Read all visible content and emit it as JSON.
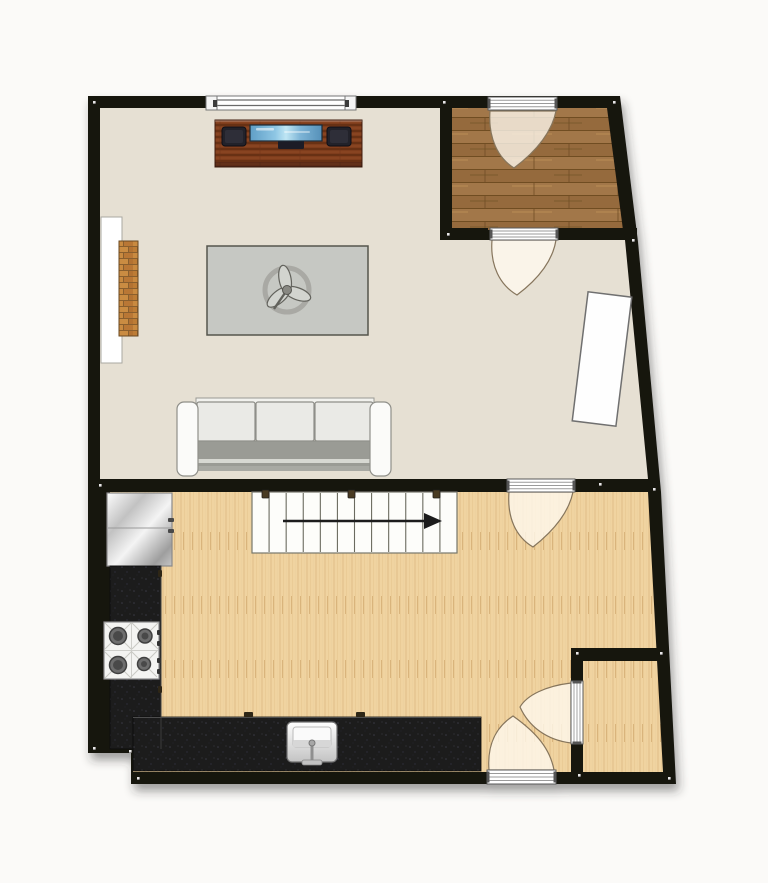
{
  "palette": {
    "background": "#fbfaf8",
    "wall": "#16120f",
    "living_floor": "#e6e0d3",
    "kitchen_floor": "#f0d3a0",
    "entry_floor": "#9d7243",
    "counter": "#1b1b1e",
    "door_swing_fill": "rgba(255,250,240,0.78)",
    "door_swing_stroke": "#86755c",
    "rug": "#c6c8c3",
    "stair_fill": "#fdfdfa",
    "tv_screen": "#8ec6e4",
    "console_wood": "#7f3e1e",
    "brick": "#c08038",
    "arrow": "#1a1a1a",
    "corner_dot": "#ffffff"
  },
  "plan": {
    "outline": "88,96 620,96 638,242 661,492 676,784 131,784 131,753 88,753",
    "floors": [
      {
        "name": "living-room-floor",
        "kind": "living",
        "points": "100,108 440,108 440,240 625,240 648,479 100,479"
      },
      {
        "name": "entry-vestibule-floor",
        "kind": "entry",
        "points": "452,108 607,108 623,230 452,230"
      },
      {
        "name": "kitchen-floor",
        "kind": "kitchen",
        "points": "110,492 648,492 663,772 133,772 133,741 110,741"
      }
    ],
    "interior_walls": [
      {
        "name": "wall-living-kitchen-left",
        "rect": [
          94,
          479,
          413,
          13
        ]
      },
      {
        "name": "wall-living-kitchen-right",
        "rect": [
          575,
          479,
          80,
          13
        ]
      },
      {
        "name": "wall-vestibule-left",
        "rect": [
          440,
          96,
          12,
          144
        ]
      },
      {
        "name": "wall-vestibule-bottom-left",
        "rect": [
          440,
          228,
          48,
          12
        ]
      },
      {
        "name": "wall-vestibule-bottom-right",
        "rect": [
          558,
          228,
          79,
          12
        ]
      },
      {
        "name": "wall-closet-top",
        "rect": [
          571,
          648,
          97,
          13
        ]
      },
      {
        "name": "wall-closet-left-upper",
        "rect": [
          571,
          661,
          12,
          21
        ]
      },
      {
        "name": "wall-closet-left-lower",
        "rect": [
          571,
          744,
          12,
          28
        ]
      }
    ],
    "window": {
      "name": "window-top-wall",
      "rect": [
        206,
        96,
        150,
        14
      ]
    },
    "doors": [
      {
        "name": "door-entry-exterior",
        "bar": [
          488,
          97,
          69,
          13
        ],
        "vertical": false,
        "swing": "M490,111 C488,138 498,158 514,168 C538,150 552,131 556,111 Z"
      },
      {
        "name": "door-entry-living",
        "bar": [
          490,
          228,
          68,
          12
        ],
        "vertical": false,
        "swing": "M492,240 C490,266 500,285 517,295 C541,277 553,259 556,240 Z"
      },
      {
        "name": "door-living-kitchen",
        "bar": [
          507,
          479,
          68,
          13
        ],
        "vertical": false,
        "swing": "M509,492 C507,518 516,537 533,547 C556,529 569,511 573,492 Z"
      },
      {
        "name": "door-closet",
        "bar": [
          571,
          681,
          12,
          63
        ],
        "vertical": true,
        "swing": "M571,683 C546,686 527,695 520,707 C529,727 547,740 571,743 Z"
      },
      {
        "name": "door-kitchen-exterior",
        "bar": [
          487,
          770,
          69,
          14
        ],
        "vertical": false,
        "swing": "M489,770 C487,745 496,727 513,716 C537,733 550,749 554,770 Z"
      }
    ],
    "stairs": {
      "name": "staircase",
      "rect": [
        252,
        492,
        205,
        61
      ],
      "treads": 11,
      "arrow": {
        "x1": 283,
        "y1": 521,
        "x2": 424,
        "y2": 521,
        "head": 18
      },
      "hooks": [
        [
          262,
          490
        ],
        [
          348,
          490
        ],
        [
          433,
          490
        ]
      ]
    },
    "furniture": {
      "tv_console": {
        "body": [
          215,
          120,
          147,
          47
        ],
        "screen": [
          250,
          125,
          72,
          16
        ],
        "speakers": [
          [
            222,
            127,
            24,
            19
          ],
          [
            327,
            127,
            24,
            19
          ]
        ],
        "component": [
          278,
          139,
          26,
          10
        ]
      },
      "rug": {
        "rect": [
          207,
          246,
          161,
          89
        ],
        "fan_center": [
          287,
          290
        ],
        "fan_ring_r": 22,
        "petal_angles": [
          20,
          140,
          260
        ]
      },
      "sofa": {
        "back": [
          196,
          398,
          178,
          8
        ],
        "cushions": [
          [
            197,
            402,
            58,
            39
          ],
          [
            256,
            402,
            58,
            39
          ],
          [
            315,
            402,
            58,
            39
          ]
        ],
        "seat": [
          197,
          441,
          176,
          29
        ],
        "front_highlight": [
          197,
          459,
          176,
          4
        ],
        "front_lip": [
          197,
          466,
          176,
          5
        ],
        "arms": [
          [
            177,
            402,
            21,
            74
          ],
          [
            370,
            402,
            21,
            74
          ]
        ]
      },
      "niche": {
        "rect": [
          101,
          217,
          21,
          146
        ]
      },
      "chimney_brick": {
        "rect": [
          119,
          241,
          19,
          95
        ]
      },
      "table": {
        "cx": 602,
        "cy": 359,
        "w": 44,
        "h": 130,
        "rotation": 7
      },
      "fridge": {
        "rect": [
          107,
          493,
          65,
          73
        ],
        "seam_y": 528,
        "handles": [
          [
            168,
            518,
            6,
            4
          ],
          [
            168,
            529,
            6,
            4
          ]
        ]
      },
      "counter_left": {
        "rect": [
          110,
          566,
          51,
          183
        ],
        "handles": [
          [
            158,
            570,
            4,
            7
          ],
          [
            158,
            686,
            4,
            7
          ]
        ]
      },
      "counter_island": {
        "rect": [
          133,
          717,
          348,
          54
        ],
        "handles": [
          [
            244,
            712,
            9,
            5
          ],
          [
            356,
            712,
            9,
            5
          ]
        ]
      },
      "stove": {
        "rect": [
          104,
          622,
          55,
          57
        ],
        "burners": [
          [
            118,
            636,
            8.5
          ],
          [
            145,
            636,
            7
          ],
          [
            118,
            665,
            8.5
          ],
          [
            144,
            664,
            6.5
          ]
        ],
        "knobs": [
          [
            157,
            630,
            4,
            5
          ],
          [
            157,
            641,
            4,
            5
          ],
          [
            157,
            658,
            4,
            5
          ],
          [
            157,
            669,
            4,
            5
          ]
        ]
      },
      "sink": {
        "outer": [
          287,
          722,
          50,
          40
        ],
        "inner": [
          293,
          727,
          38,
          20
        ],
        "stem": [
          312,
          742,
          312,
          764
        ],
        "crossbar": [
          302,
          760,
          20,
          5
        ]
      }
    },
    "corner_dots": [
      [
        93,
        101
      ],
      [
        613,
        101
      ],
      [
        443,
        101
      ],
      [
        447,
        233
      ],
      [
        632,
        239
      ],
      [
        599,
        483
      ],
      [
        653,
        488
      ],
      [
        99,
        484
      ],
      [
        93,
        747
      ],
      [
        129,
        750
      ],
      [
        137,
        777
      ],
      [
        668,
        777
      ],
      [
        576,
        652
      ],
      [
        660,
        652
      ],
      [
        578,
        774
      ]
    ]
  }
}
